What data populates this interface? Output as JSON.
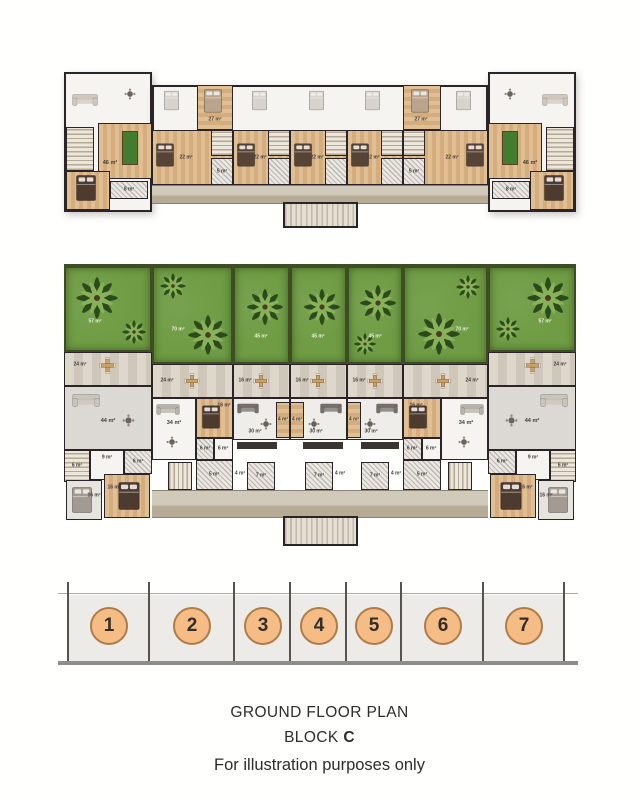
{
  "captions": {
    "title": "GROUND FLOOR PLAN",
    "block_word": "BLOCK",
    "block_letter": "C",
    "disclaimer": "For illustration purposes only"
  },
  "key": {
    "numbers": [
      "1",
      "2",
      "3",
      "4",
      "5",
      "6",
      "7"
    ]
  },
  "upper_plan": {
    "units": [
      {
        "family": "46 m²",
        "bath": "8 m²"
      },
      {
        "loft": "27 m²",
        "bedroom": "22 m²",
        "bath": "5 m²"
      },
      {
        "bedroom": "22 m²"
      },
      {
        "bedroom": "22 m²"
      },
      {
        "bedroom": "22 m²"
      },
      {
        "loft": "27 m²",
        "bedroom": "22 m²",
        "bath": "5 m²"
      },
      {
        "family": "46 m²",
        "bath": "8 m²"
      }
    ]
  },
  "ground_plan": {
    "units": [
      {
        "garden": "57 m²",
        "terrace": "24 m²",
        "living": "44 m²",
        "hall": "9 m²",
        "stairs": "6 m²",
        "bath": "6 m²",
        "bedroom_a": "16 m²",
        "bedroom_b": "16 m²"
      },
      {
        "garden": "70 m²",
        "terrace": "24 m²",
        "living": "34 m²",
        "bedroom": "16 m²",
        "wc": "6 m²",
        "hall": "6 m²",
        "bath": "5 m²"
      },
      {
        "garden": "45 m²",
        "terrace": "16 m²",
        "living": "30 m²",
        "deck": "4 m²",
        "bath": "7 m²",
        "hall": "4 m²"
      },
      {
        "garden": "45 m²",
        "terrace": "16 m²",
        "living": "30 m²",
        "deck": "4 m²",
        "bath": "7 m²",
        "hall": "4 m²"
      },
      {
        "garden": "45 m²",
        "terrace": "16 m²",
        "living": "30 m²",
        "deck": "4 m²",
        "bath": "7 m²",
        "hall": "4 m²"
      },
      {
        "garden": "70 m²",
        "terrace": "24 m²",
        "living": "34 m²",
        "bedroom": "16 m²",
        "wc": "6 m²",
        "hall": "6 m²",
        "bath": "5 m²"
      },
      {
        "garden": "57 m²",
        "terrace": "24 m²",
        "living": "44 m²",
        "hall": "9 m²",
        "stairs": "6 m²",
        "bath": "6 m²",
        "bedroom_a": "16 m²",
        "bedroom_b": "16 m²"
      }
    ]
  },
  "colors": {
    "unit_badge": "#f5bd85",
    "unit_badge_border": "#ae7d47",
    "garden_green": "#6f9c44",
    "wood_floor": "#ddb88c",
    "terrace_stone": "#d9d1c4",
    "wall": "#2a2428",
    "corridor": "#c7bba7"
  }
}
